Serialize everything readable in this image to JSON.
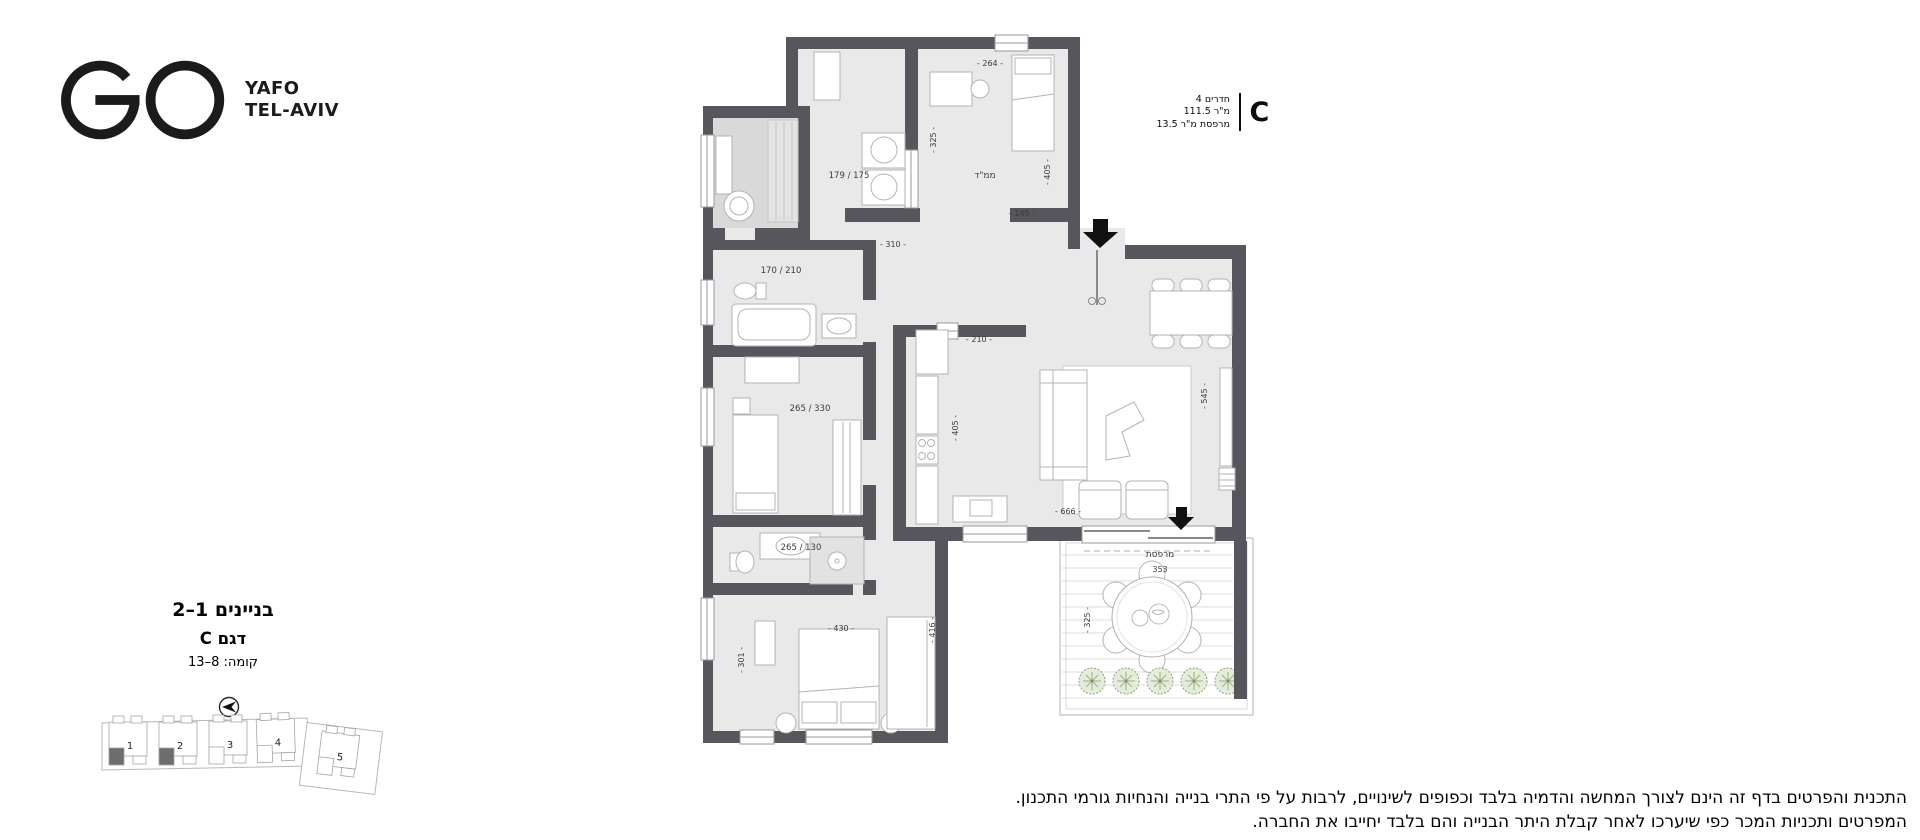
{
  "logo": {
    "go": "GO",
    "city_line1": "YAFO",
    "city_line2": "TEL-AVIV"
  },
  "unit_info": {
    "model": "C",
    "lines": [
      {
        "parts": [
          "4",
          "חדרים"
        ]
      },
      {
        "parts": [
          "111.5",
          "מ\"ר"
        ]
      },
      {
        "parts": [
          "13.5",
          "מ\"ר",
          "מרפסת"
        ]
      }
    ]
  },
  "title_block": {
    "buildings": "בניינים 1–2",
    "model": "דגם C",
    "floors": "קומה: 8–13"
  },
  "site_plan": {
    "buildings": [
      {
        "num": "1",
        "highlight": true
      },
      {
        "num": "2",
        "highlight": true
      },
      {
        "num": "3",
        "highlight": false
      },
      {
        "num": "4",
        "highlight": false
      },
      {
        "num": "5",
        "highlight": false
      }
    ]
  },
  "floor_plan": {
    "rooms": {
      "mamad": "ממ\"ד",
      "bath_top": "179 / 175",
      "bath_mid": "170 / 210",
      "bedroom2": "265 / 330",
      "bath_lower": "265 / 130",
      "balcony": "מרפסת"
    },
    "dims": {
      "d264": "- 264 -",
      "d405a": "- 405 -",
      "d325a": "- 325 -",
      "d145": "- 145 -",
      "d310": "- 310 -",
      "d210": "- 210 -",
      "d405b": "- 405 -",
      "d545": "- 545 -",
      "d666": "- 666 -",
      "d430": "- 430 -",
      "d301": "- 301 -",
      "d416": "- 416 -",
      "d353": "353",
      "d325b": "- 325 -"
    }
  },
  "disclaimer": {
    "line1": "התכנית והפרטים בדף זה הינם לצורך המחשה והדמיה בלבד וכפופים לשינויים, לרבות על פי התרי בנייה והנחיות גורמי התכנון.",
    "line2": "המפרטים ותכניות המכר כפי שיערכו לאחר קבלת היתר הבנייה והם בלבד יחייבו את החברה."
  }
}
